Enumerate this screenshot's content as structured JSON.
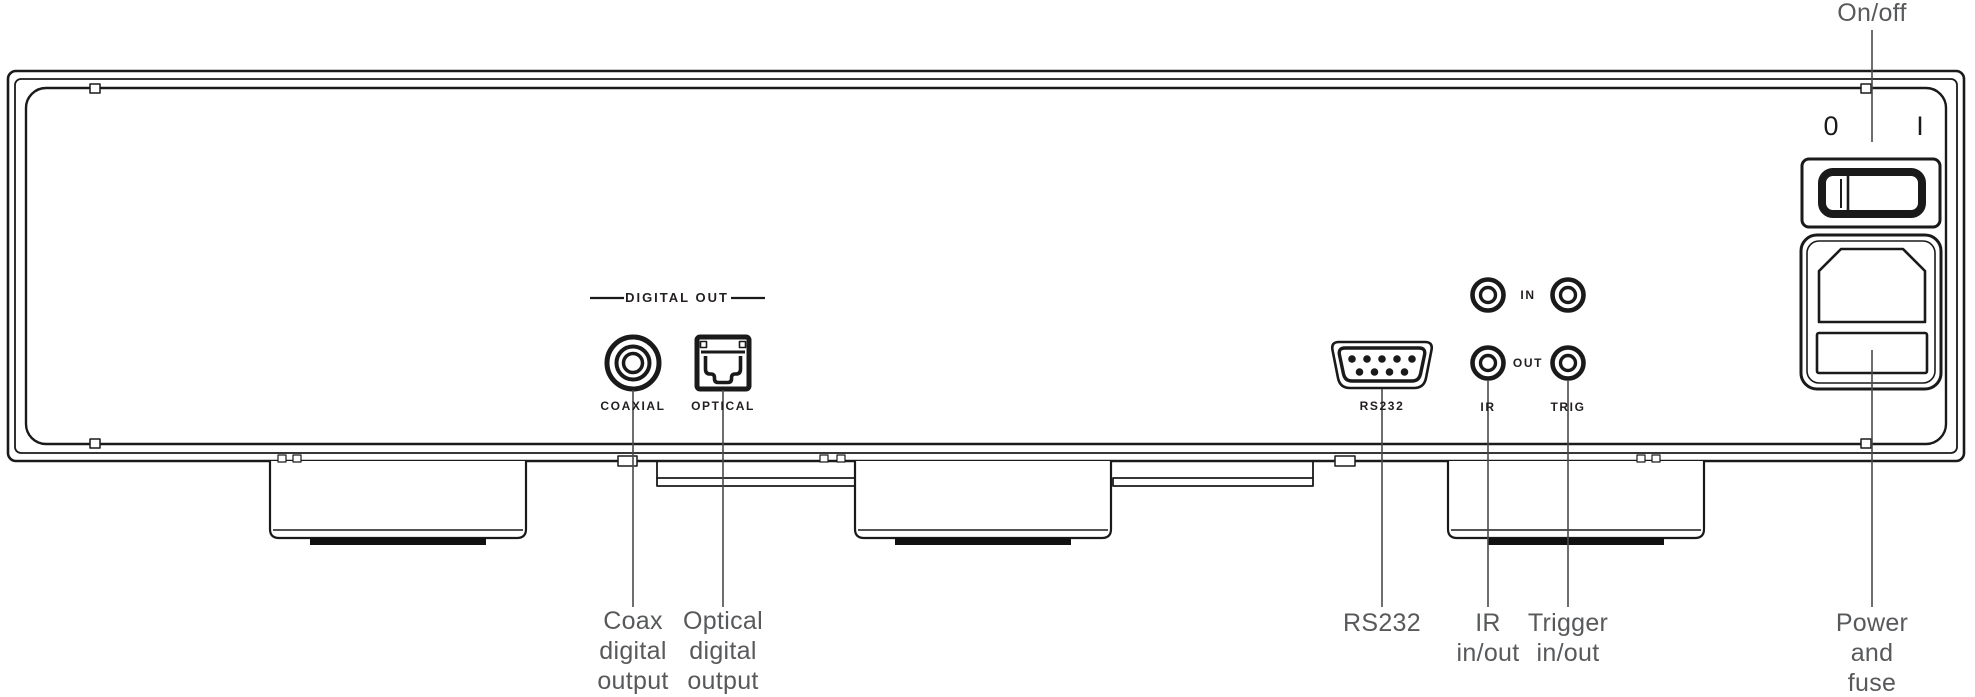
{
  "title": "Audio component rear panel diagram",
  "colors": {
    "line": "#1a1a1a",
    "caption_gray": "#58595b",
    "panel_label": "#231f20"
  },
  "panel_labels": {
    "digital_out_header": "DIGITAL OUT",
    "coaxial": "COAXIAL",
    "optical": "OPTICAL",
    "rs232": "RS232",
    "in": "IN",
    "out": "OUT",
    "ir": "IR",
    "trig": "TRIG",
    "switch_off": "0",
    "switch_on": "I"
  },
  "callouts": {
    "on_off": "On/off",
    "coax_output": "Coax\ndigital\noutput",
    "optical_output": "Optical\ndigital\noutput",
    "rs232": "RS232",
    "ir_in_out": "IR\nin/out",
    "trigger_in_out": "Trigger\nin/out",
    "power_fuse": "Power and\nfuse"
  },
  "icons": [
    "coaxial-rca-connector",
    "optical-toslink-connector",
    "rs232-db9-connector",
    "ir-in-jack",
    "trig-in-jack",
    "ir-out-jack",
    "trig-out-jack",
    "power-rocker-switch",
    "iec-power-inlet",
    "fuse-drawer"
  ]
}
